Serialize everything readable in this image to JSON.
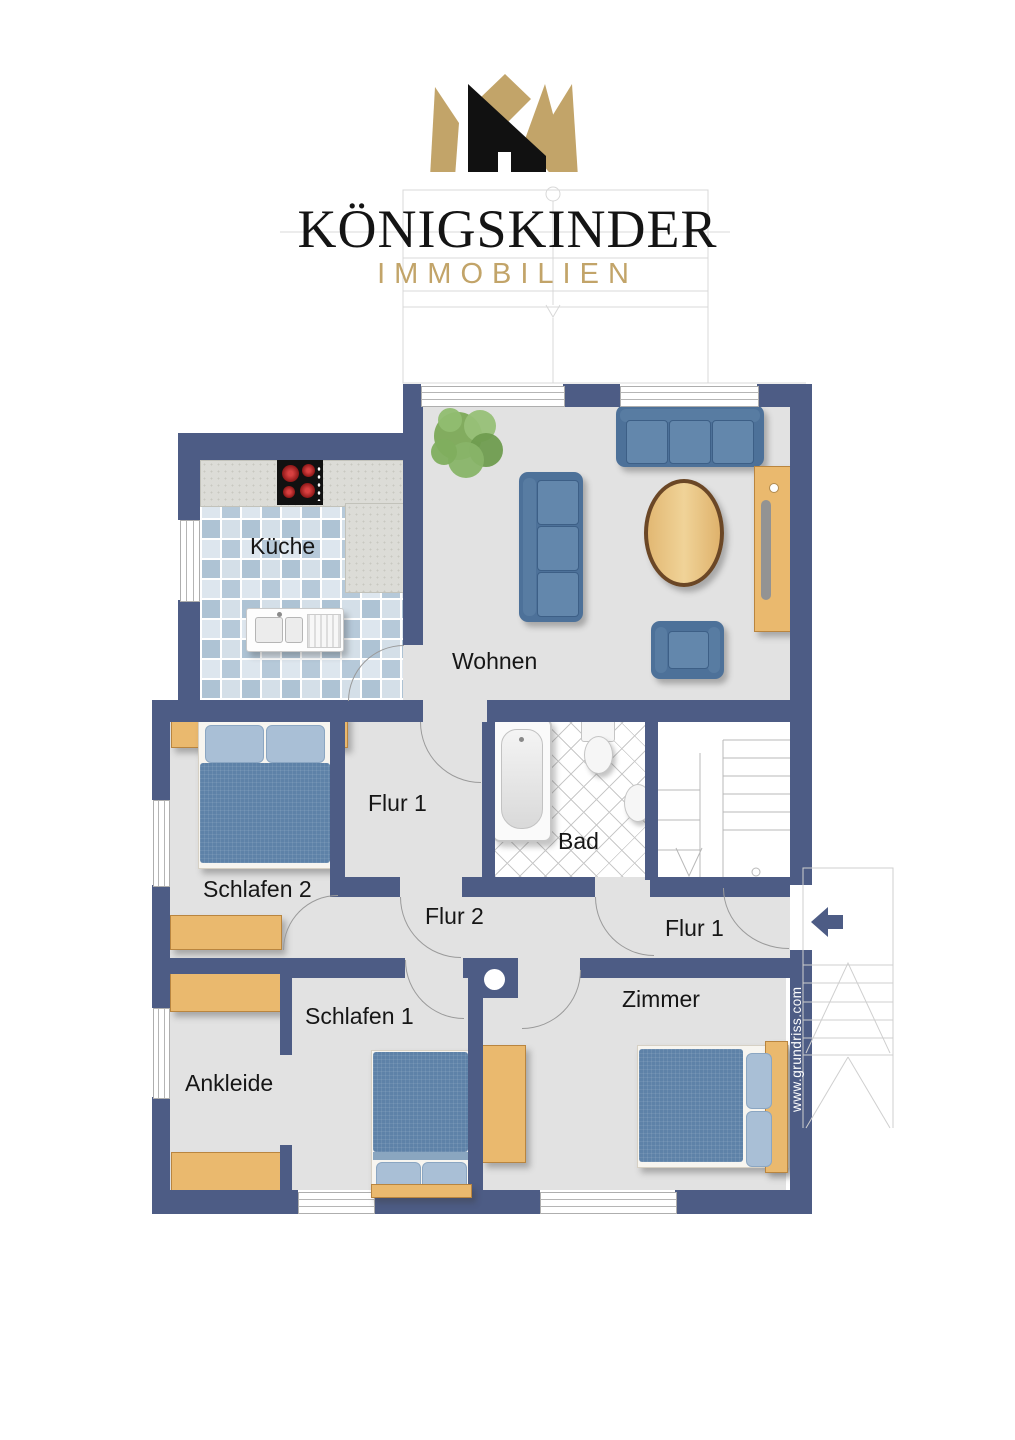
{
  "brand": {
    "title": "KÖNIGSKINDER",
    "subtitle": "IMMOBILIEN"
  },
  "watermark": "www.grundriss.com",
  "rooms": [
    {
      "id": "kueche",
      "label": "Küche"
    },
    {
      "id": "wohnen",
      "label": "Wohnen"
    },
    {
      "id": "flur1-upper",
      "label": "Flur 1"
    },
    {
      "id": "bad",
      "label": "Bad"
    },
    {
      "id": "schlafen2",
      "label": "Schlafen 2"
    },
    {
      "id": "flur2",
      "label": "Flur 2"
    },
    {
      "id": "flur1-lower",
      "label": "Flur 1"
    },
    {
      "id": "ankleide",
      "label": "Ankleide"
    },
    {
      "id": "schlafen1",
      "label": "Schlafen 1"
    },
    {
      "id": "zimmer",
      "label": "Zimmer"
    }
  ],
  "colors": {
    "wall": "#4d5c85",
    "floor": "#e2e2e2",
    "wood": "#eab96e",
    "gold": "#c2a469",
    "sofa": "#4d7199",
    "duvet": "#5e82a8",
    "tile": "#b6c9d9"
  }
}
